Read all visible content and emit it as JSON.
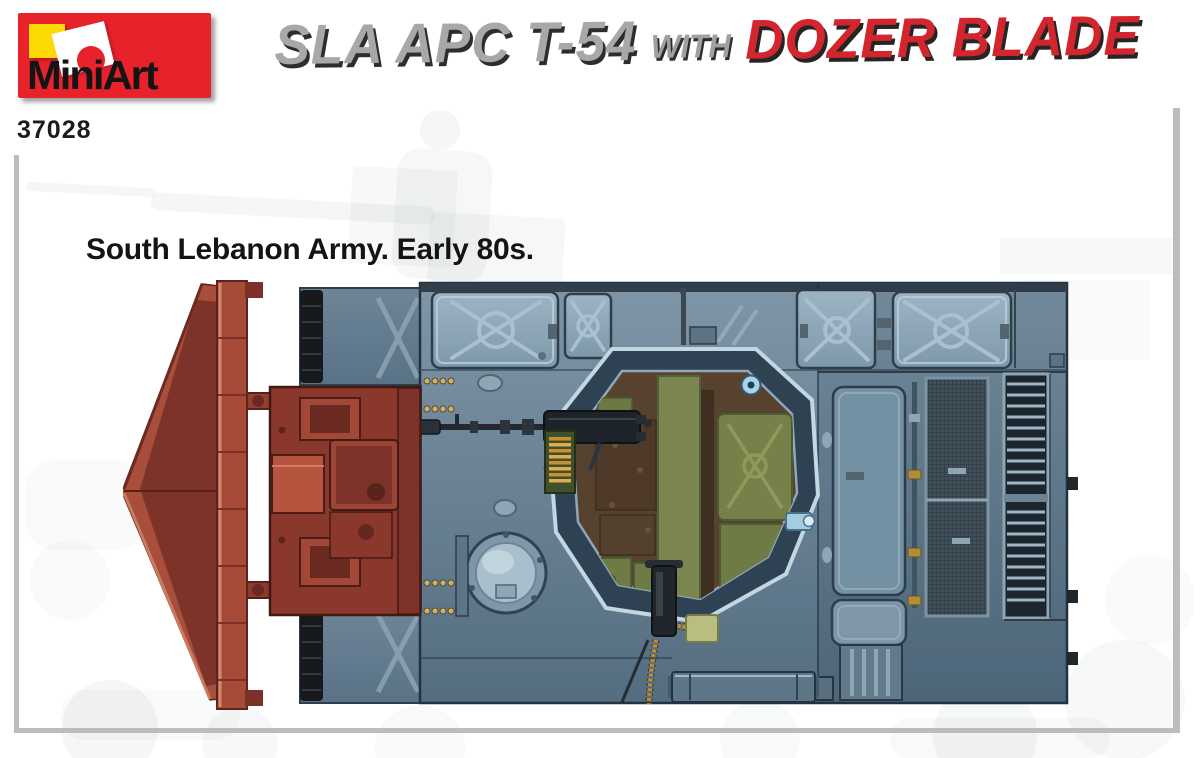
{
  "page": {
    "width": 1200,
    "height": 758,
    "background": "#ffffff"
  },
  "header": {
    "logo": {
      "brand": "MiniArt",
      "background": "#e7222b",
      "square_color": "#fdd905"
    },
    "kit_number": "37028",
    "title": {
      "segment1": "SLA APC T-54",
      "segment2": "WITH",
      "segment3": "DOZER BLADE",
      "segment1_color": "#a8a8a8",
      "segment3_color": "#d2252d"
    }
  },
  "caption": {
    "text": "South Lebanon Army. Early 80s.",
    "color": "#141414"
  },
  "frame": {
    "color": "#bcbcbc"
  },
  "artwork": {
    "description": "Top view box-art illustration of an SLA APC T-54 with dozer blade",
    "palette": {
      "blade_red": "#a84e3b",
      "push_frame_red": "#8b382c",
      "hull_blue_gray": "#6d8496",
      "stowage_bin_blue": "#8aa2b4",
      "interior_brown": "#57422f",
      "interior_green": "#76814a",
      "track_black": "#17191c",
      "ammo_gold": "#c89031"
    },
    "parts": [
      "dozer blade",
      "push frame",
      "hull",
      "stowage bins",
      "turret ring opening",
      "DShK machine gun",
      "ammo box",
      "dome hatch",
      "engine mesh grille",
      "louver grille",
      "bottom rail",
      "tracks"
    ]
  }
}
